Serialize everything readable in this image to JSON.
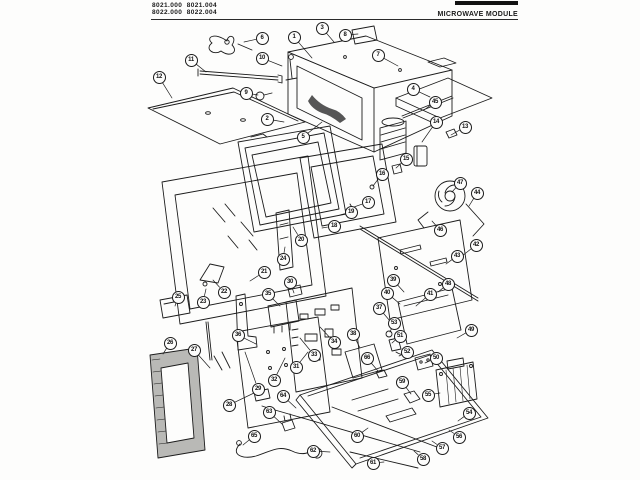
{
  "header": {
    "model_line1": "8021.000  8021.004",
    "model_line2": "8022.000  8022.004",
    "title": "MICROWAVE MODULE"
  },
  "colors": {
    "ink": "#1a1a1a",
    "paper": "#fdfdfc"
  },
  "diagram": {
    "callouts": [
      {
        "n": "1",
        "x": 294,
        "y": 37,
        "tx": 312,
        "ty": 58
      },
      {
        "n": "2",
        "x": 267,
        "y": 119,
        "tx": 284,
        "ty": 122
      },
      {
        "n": "3",
        "x": 322,
        "y": 28,
        "tx": 334,
        "ty": 42
      },
      {
        "n": "4",
        "x": 413,
        "y": 89,
        "tx": 430,
        "ty": 97
      },
      {
        "n": "5",
        "x": 303,
        "y": 137,
        "tx": 322,
        "ty": 122
      },
      {
        "n": "6",
        "x": 262,
        "y": 38,
        "tx": 244,
        "ty": 42
      },
      {
        "n": "7",
        "x": 378,
        "y": 55,
        "tx": 398,
        "ty": 66
      },
      {
        "n": "8",
        "x": 345,
        "y": 35,
        "tx": 358,
        "ty": 34
      },
      {
        "n": "9",
        "x": 246,
        "y": 93,
        "tx": 258,
        "ty": 95
      },
      {
        "n": "10",
        "x": 262,
        "y": 58,
        "tx": 282,
        "ty": 66
      },
      {
        "n": "11",
        "x": 191,
        "y": 60,
        "tx": 206,
        "ty": 72
      },
      {
        "n": "12",
        "x": 159,
        "y": 77,
        "tx": 172,
        "ty": 98
      },
      {
        "n": "13",
        "x": 465,
        "y": 127,
        "tx": 451,
        "ty": 135
      },
      {
        "n": "14",
        "x": 436,
        "y": 122,
        "tx": 422,
        "ty": 142
      },
      {
        "n": "15",
        "x": 406,
        "y": 159,
        "tx": 396,
        "ty": 168
      },
      {
        "n": "16",
        "x": 382,
        "y": 174,
        "tx": 373,
        "ty": 186
      },
      {
        "n": "17",
        "x": 368,
        "y": 202,
        "tx": 354,
        "ty": 207
      },
      {
        "n": "18",
        "x": 334,
        "y": 226,
        "tx": 322,
        "ty": 228
      },
      {
        "n": "19",
        "x": 351,
        "y": 212,
        "tx": 340,
        "ty": 215
      },
      {
        "n": "20",
        "x": 301,
        "y": 240,
        "tx": 293,
        "ty": 227
      },
      {
        "n": "21",
        "x": 264,
        "y": 272,
        "tx": 250,
        "ty": 281
      },
      {
        "n": "22",
        "x": 224,
        "y": 292,
        "tx": 213,
        "ty": 280
      },
      {
        "n": "23",
        "x": 203,
        "y": 302,
        "tx": 206,
        "ty": 289
      },
      {
        "n": "24",
        "x": 283,
        "y": 259,
        "tx": 285,
        "ty": 247
      },
      {
        "n": "25",
        "x": 178,
        "y": 297,
        "tx": 175,
        "ty": 306
      },
      {
        "n": "26",
        "x": 170,
        "y": 343,
        "tx": 163,
        "ty": 354
      },
      {
        "n": "27",
        "x": 194,
        "y": 350,
        "tx": 210,
        "ty": 368
      },
      {
        "n": "28",
        "x": 229,
        "y": 405,
        "tx": 254,
        "ty": 393
      },
      {
        "n": "29",
        "x": 258,
        "y": 389,
        "tx": 245,
        "ty": 352
      },
      {
        "n": "30",
        "x": 290,
        "y": 282,
        "tx": 294,
        "ty": 293
      },
      {
        "n": "31",
        "x": 296,
        "y": 367,
        "tx": 308,
        "ty": 352
      },
      {
        "n": "32",
        "x": 274,
        "y": 380,
        "tx": 285,
        "ty": 358
      },
      {
        "n": "33",
        "x": 314,
        "y": 355,
        "tx": 300,
        "ty": 338
      },
      {
        "n": "34",
        "x": 334,
        "y": 342,
        "tx": 320,
        "ty": 327
      },
      {
        "n": "35",
        "x": 268,
        "y": 294,
        "tx": 280,
        "ty": 306
      },
      {
        "n": "36",
        "x": 238,
        "y": 335,
        "tx": 256,
        "ty": 344
      },
      {
        "n": "37",
        "x": 379,
        "y": 308,
        "tx": 390,
        "ty": 321
      },
      {
        "n": "38",
        "x": 353,
        "y": 334,
        "tx": 360,
        "ty": 348
      },
      {
        "n": "39",
        "x": 393,
        "y": 280,
        "tx": 404,
        "ty": 292
      },
      {
        "n": "40",
        "x": 387,
        "y": 293,
        "tx": 400,
        "ty": 304
      },
      {
        "n": "41",
        "x": 430,
        "y": 294,
        "tx": 416,
        "ty": 306
      },
      {
        "n": "42",
        "x": 476,
        "y": 245,
        "tx": 462,
        "ty": 256
      },
      {
        "n": "43",
        "x": 457,
        "y": 256,
        "tx": 446,
        "ty": 264
      },
      {
        "n": "44",
        "x": 477,
        "y": 193,
        "tx": 469,
        "ty": 206
      },
      {
        "n": "45",
        "x": 435,
        "y": 102,
        "tx": 424,
        "ty": 110
      },
      {
        "n": "46",
        "x": 440,
        "y": 230,
        "tx": 432,
        "ty": 221
      },
      {
        "n": "47",
        "x": 460,
        "y": 183,
        "tx": 452,
        "ty": 192
      },
      {
        "n": "48",
        "x": 448,
        "y": 284,
        "tx": 438,
        "ty": 292
      },
      {
        "n": "49",
        "x": 471,
        "y": 330,
        "tx": 457,
        "ty": 338
      },
      {
        "n": "50",
        "x": 436,
        "y": 358,
        "tx": 425,
        "ty": 363
      },
      {
        "n": "51",
        "x": 400,
        "y": 336,
        "tx": 392,
        "ty": 343
      },
      {
        "n": "52",
        "x": 407,
        "y": 352,
        "tx": 399,
        "ty": 356
      },
      {
        "n": "53",
        "x": 394,
        "y": 323,
        "tx": 390,
        "ty": 332
      },
      {
        "n": "54",
        "x": 469,
        "y": 413,
        "tx": 458,
        "ty": 421
      },
      {
        "n": "55",
        "x": 428,
        "y": 395,
        "tx": 440,
        "ty": 393
      },
      {
        "n": "56",
        "x": 459,
        "y": 437,
        "tx": 449,
        "ty": 430
      },
      {
        "n": "57",
        "x": 442,
        "y": 448,
        "tx": 432,
        "ty": 441
      },
      {
        "n": "58",
        "x": 423,
        "y": 459,
        "tx": 414,
        "ty": 451
      },
      {
        "n": "59",
        "x": 402,
        "y": 382,
        "tx": 411,
        "ty": 394
      },
      {
        "n": "60",
        "x": 357,
        "y": 436,
        "tx": 368,
        "ty": 428
      },
      {
        "n": "61",
        "x": 373,
        "y": 463,
        "tx": 384,
        "ty": 462
      },
      {
        "n": "62",
        "x": 313,
        "y": 451,
        "tx": 330,
        "ty": 452
      },
      {
        "n": "63",
        "x": 269,
        "y": 412,
        "tx": 282,
        "ty": 424
      },
      {
        "n": "64",
        "x": 283,
        "y": 396,
        "tx": 296,
        "ty": 408
      },
      {
        "n": "65",
        "x": 254,
        "y": 436,
        "tx": 243,
        "ty": 445
      },
      {
        "n": "66",
        "x": 367,
        "y": 358,
        "tx": 378,
        "ty": 371
      }
    ]
  }
}
